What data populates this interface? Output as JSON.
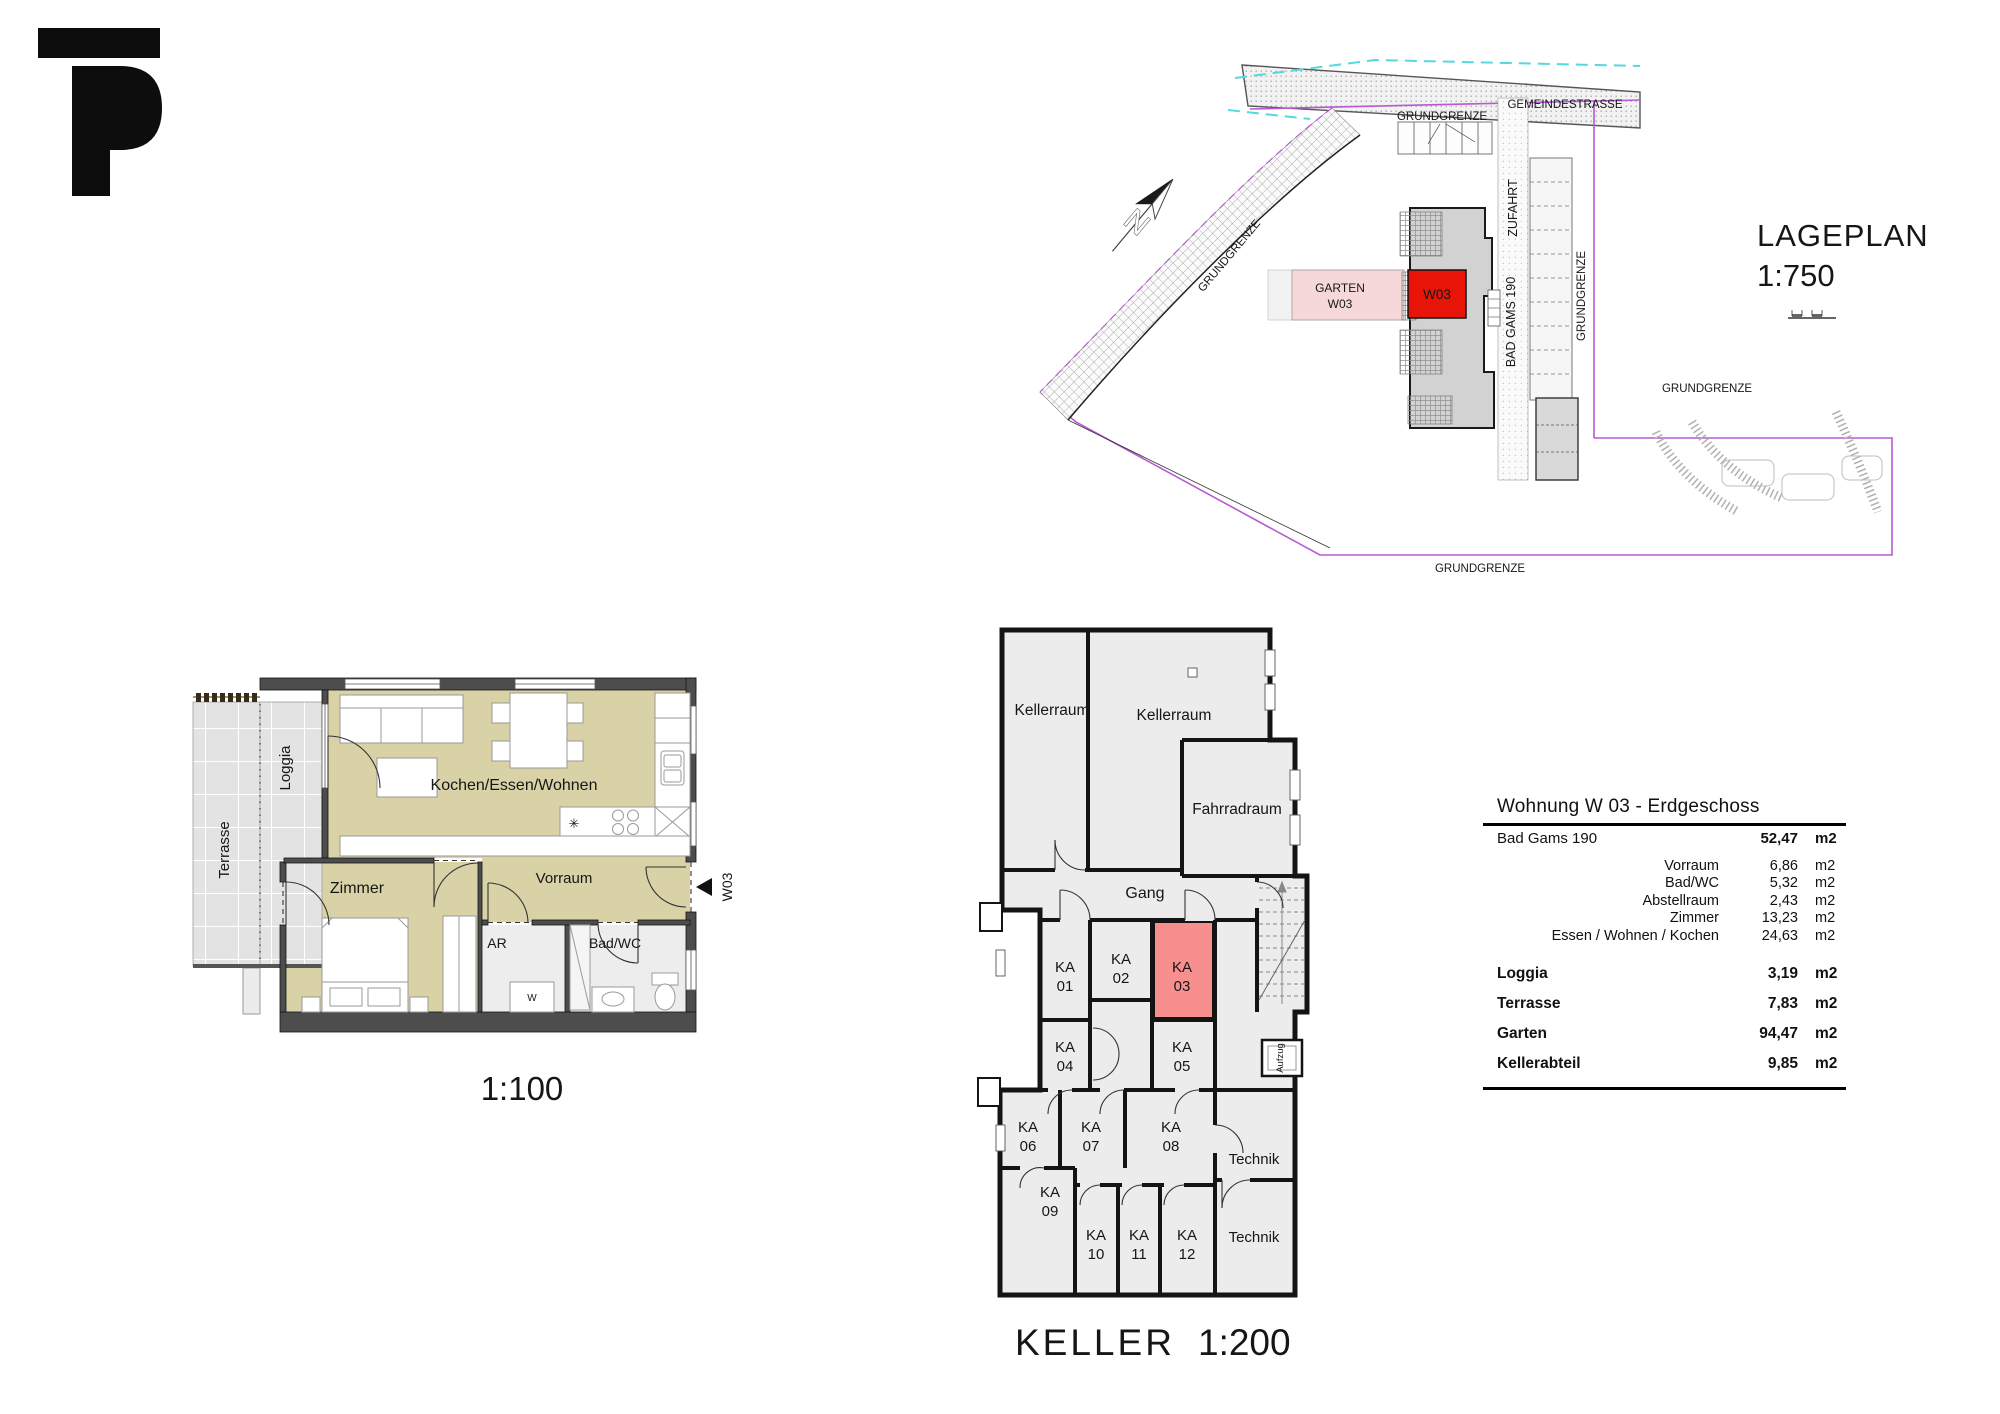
{
  "colors": {
    "room_tan": "#d8d2a6",
    "room_gray": "#ececec",
    "tile_gray": "#e3e3e3",
    "wall_dark": "#4d4d4d",
    "unit_red": "#e81407",
    "ka_red": "#f78f8f",
    "garten_pink": "#f7d8d8",
    "boundary_magenta": "#b75ad2",
    "water_cyan": "#56d8e0"
  },
  "logo": {
    "brand": "P"
  },
  "lageplan": {
    "title": "LAGEPLAN",
    "scale": "1:750",
    "street": "GEMEINDESTRASSE",
    "boundary": "GRUNDGRENZE",
    "zufahrt": "ZUFAHRT",
    "address": "BAD GAMS 190",
    "garten_line1": "GARTEN",
    "garten_line2": "W03",
    "unit": "W03",
    "north": "N"
  },
  "floorplan": {
    "scale": "1:100",
    "unit": "W03",
    "washer": "W",
    "rooms": {
      "loggia": "Loggia",
      "terrasse": "Terrasse",
      "wohnen": "Kochen/Essen/Wohnen",
      "zimmer": "Zimmer",
      "vorraum": "Vorraum",
      "ar": "AR",
      "bad": "Bad/WC"
    }
  },
  "keller": {
    "title": "KELLER",
    "scale": "1:200",
    "ka_prefix": "KA",
    "ka": [
      "01",
      "02",
      "03",
      "04",
      "05",
      "06",
      "07",
      "08",
      "09",
      "10",
      "11",
      "12"
    ],
    "rooms": {
      "kellerraum1": "Kellerraum",
      "kellerraum2": "Kellerraum",
      "fahrradraum": "Fahrradraum",
      "gang": "Gang",
      "technik1": "Technik",
      "technik2": "Technik",
      "aufzug": "Aufzug"
    }
  },
  "table": {
    "title": "Wohnung  W 03  - Erdgeschoss",
    "main_row": {
      "label": "Bad Gams 190",
      "value": "52,47",
      "unit": "m2"
    },
    "sub_rows": [
      {
        "label": "Vorraum",
        "value": "6,86",
        "unit": "m2"
      },
      {
        "label": "Bad/WC",
        "value": "5,32",
        "unit": "m2"
      },
      {
        "label": "Abstellraum",
        "value": "2,43",
        "unit": "m2"
      },
      {
        "label": "Zimmer",
        "value": "13,23",
        "unit": "m2"
      },
      {
        "label": "Essen / Wohnen / Kochen",
        "value": "24,63",
        "unit": "m2"
      }
    ],
    "bold_rows": [
      {
        "label": "Loggia",
        "value": "3,19",
        "unit": "m2"
      },
      {
        "label": "Terrasse",
        "value": "7,83",
        "unit": "m2"
      },
      {
        "label": "Garten",
        "value": "94,47",
        "unit": "m2"
      },
      {
        "label": "Kellerabteil",
        "value": "9,85",
        "unit": "m2"
      }
    ]
  }
}
